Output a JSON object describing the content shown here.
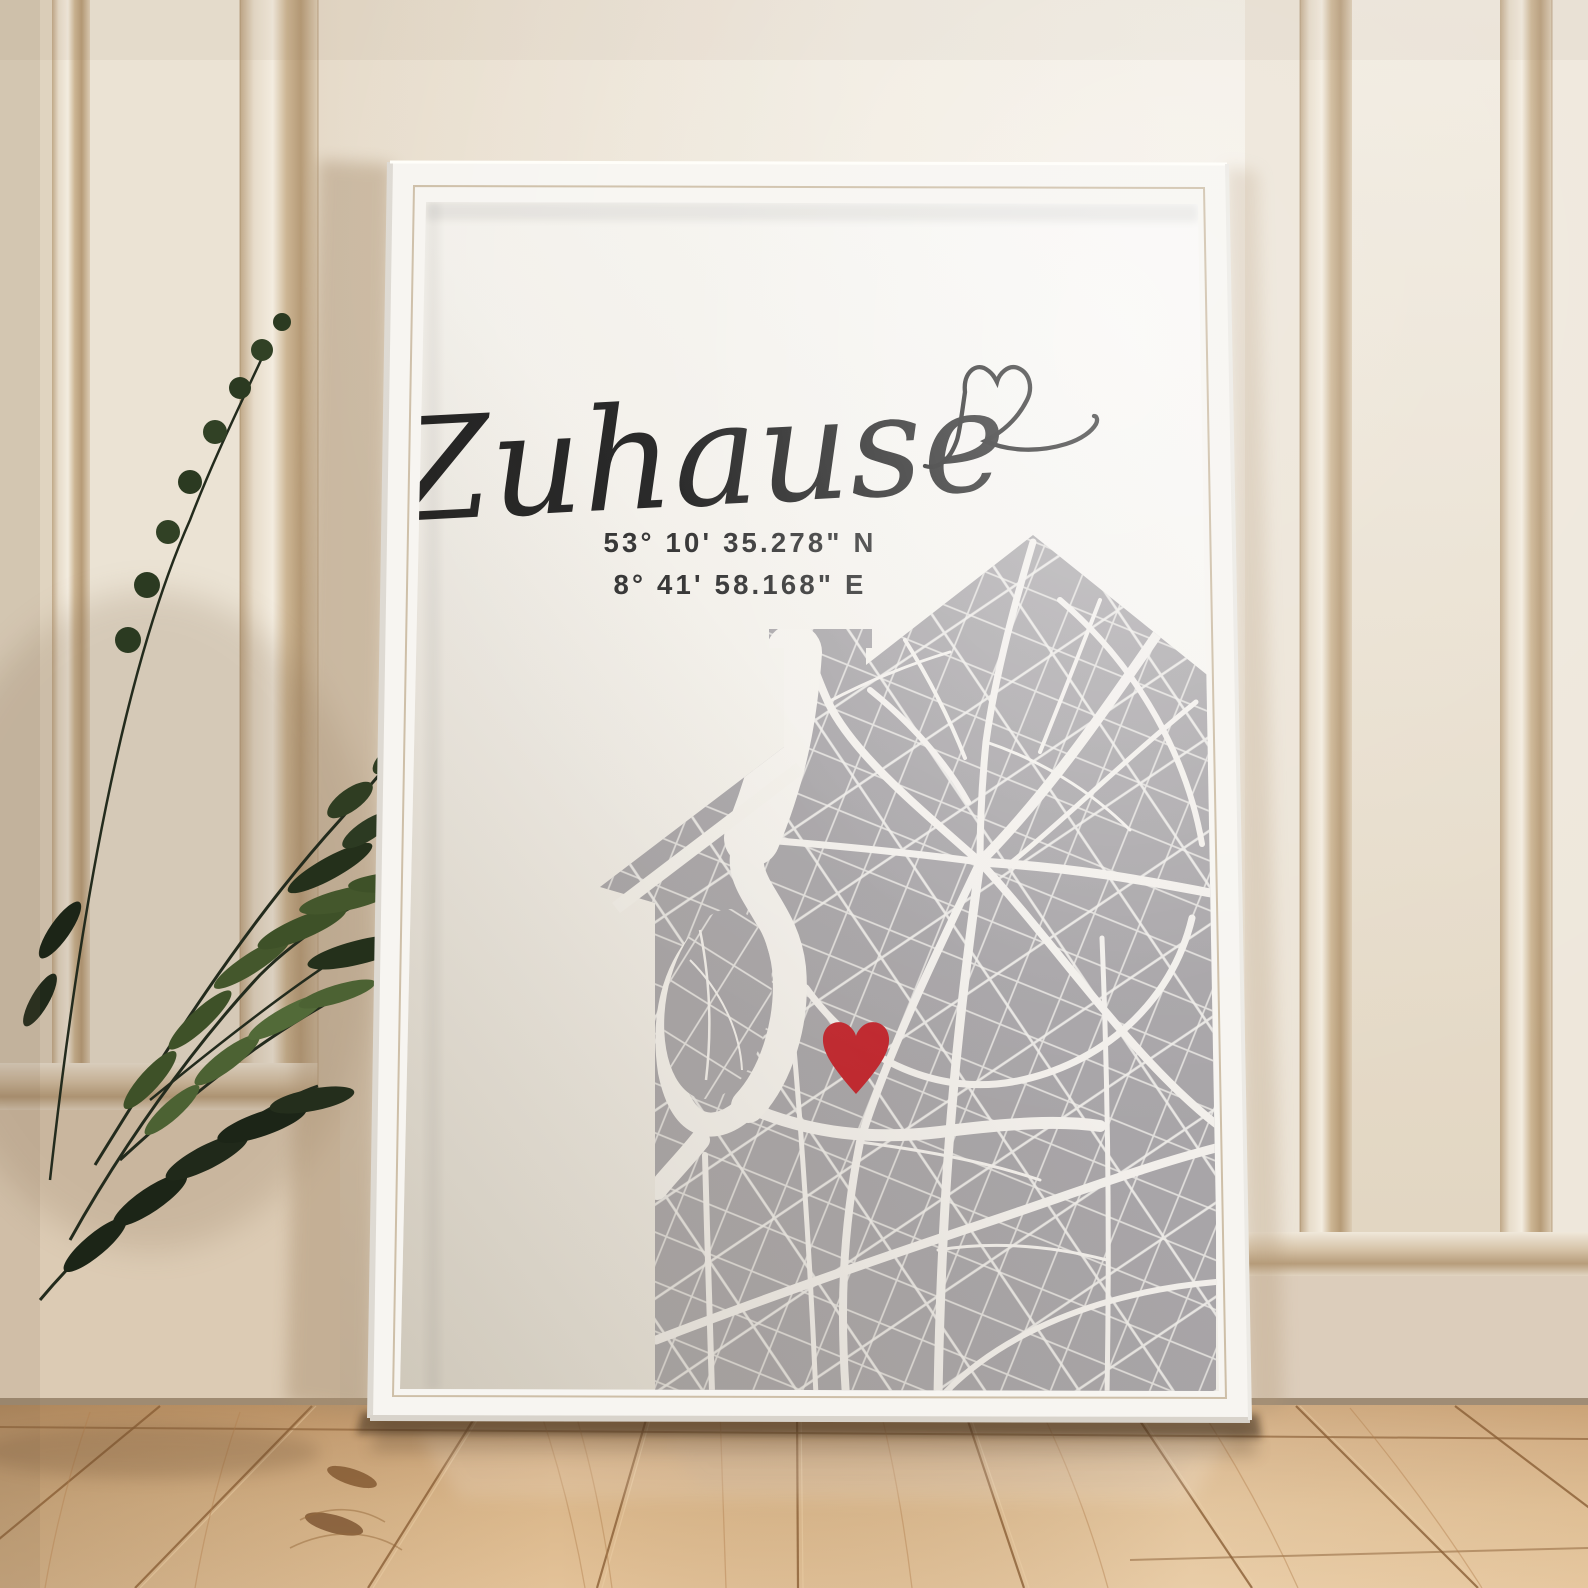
{
  "poster": {
    "title": "Zuhause",
    "coordinates": {
      "latitude": "53° 10' 35.278\" N",
      "longitude": "8° 41' 58.168\" E"
    },
    "marker": {
      "icon": "heart-icon",
      "color": "#c2232b"
    },
    "map": {
      "shape": "house-silhouette",
      "land_color": "#a8a5a8",
      "street_color": "#f2efeb",
      "paper_color": "#f3f0ea"
    },
    "ink_color": "#1b1b1b"
  },
  "room": {
    "wall_color": "#e9e0d2",
    "molding_color": "#c9b393",
    "floor_color": "#d7b289",
    "frame_color": "#f7f5f1",
    "plant_color": "#2c3a22"
  }
}
